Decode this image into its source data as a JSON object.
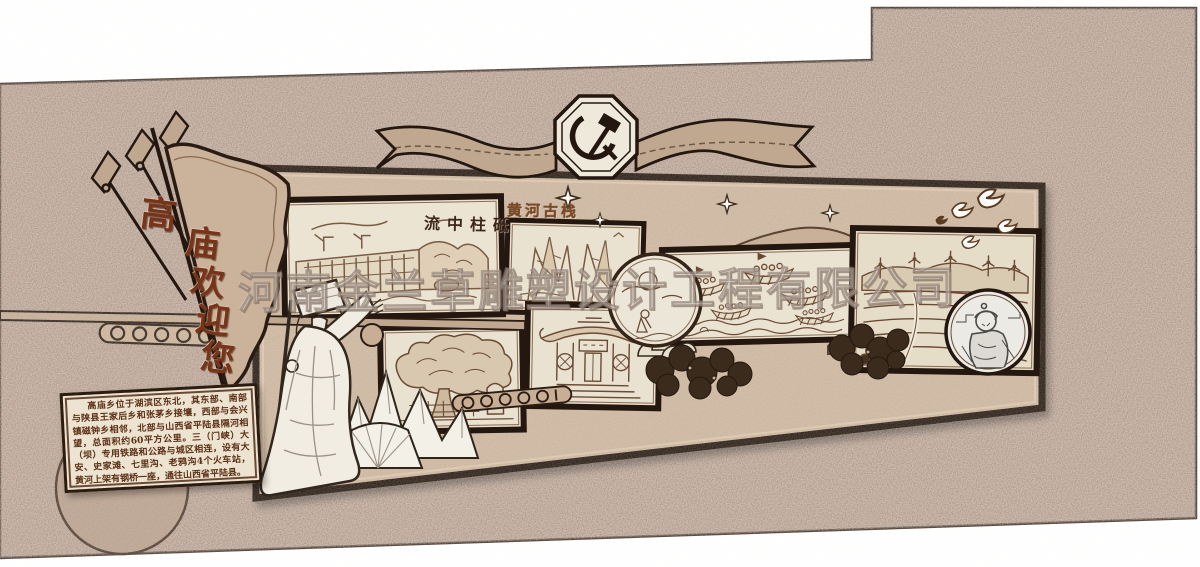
{
  "scene": {
    "kind": "cultural-wall-design-rendering",
    "colors": {
      "background_wall": "#a28877",
      "feature_wall": "#c8b199",
      "panel_paper": "#ebe4d2",
      "dark_outline": "#241710",
      "sketch_sepia": "#6b4a35",
      "pennant_text": "#76351a",
      "board_text": "#5c2f16"
    },
    "icons": [
      "party-emblem-icon",
      "spear-icon",
      "sparkle-star-icon",
      "dove-icon",
      "dam-scene-icon",
      "cliff-path-scene-icon",
      "river-boats-scene-icon",
      "temple-scene-icon",
      "ancient-tree-scene-icon",
      "terraces-windmills-scene-icon",
      "sun-landscape-medallion-icon",
      "portrait-medallion-icon",
      "yu-the-great-statue-icon",
      "scroll-ribbon-icon",
      "cloud-scroll-bar-icon"
    ]
  },
  "watermark": {
    "text": "河南金兰草雕塑设计工程有限公司"
  },
  "pennant": {
    "text": "高庙欢迎您",
    "chars": [
      "高",
      "庙",
      "欢",
      "迎",
      "您"
    ]
  },
  "panels": {
    "dam": {
      "caption": "流中柱砥"
    },
    "cliff": {
      "label": "黄河古栈"
    }
  },
  "info_board": {
    "text": "高庙乡位于湖滨区东北，其东部、南部与陕县王家后乡和张茅乡接壤，西部与会兴镇磁钟乡相邻，北部与山西省平陆县隔河相望，总面积约60平方公里。三（门峡）大（坝）专用铁路和公路与城区相连，设有大安、史家滩、七里沟、老鸦沟4个火车站，黄河上架有钢桥一座，通往山西省平陆县。"
  }
}
